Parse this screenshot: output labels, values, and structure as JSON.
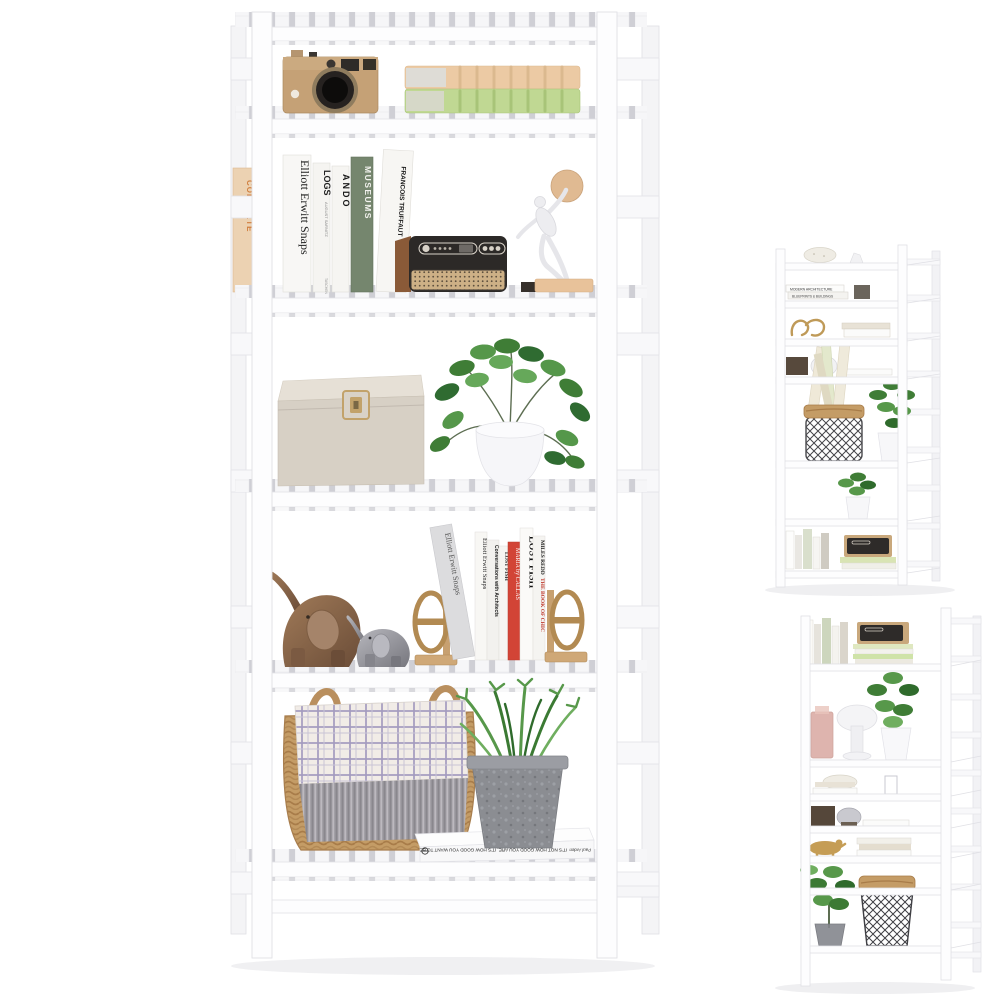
{
  "image": {
    "type": "product-photo",
    "subject": "6-tier white slatted bamboo bookshelf styled with decor, shown in one large front view and two smaller angled views",
    "background": "#ffffff",
    "views": {
      "main_front_view": {
        "tiers": "6",
        "shelf_items": {
          "tier1": [
            "vintage camera (tan with black lens)",
            "two stacked books (peach and green)"
          ],
          "tier2": [
            "leaning peach book",
            "book row: Elliott Erwitt Snaps / LOGS / ANDO / MUSEUMS / Francois Truffaut",
            "retro speaker radio (dark front, wood side, tan grille)",
            "white discus-thrower statue with tan disc on base"
          ],
          "tier3": [
            "beige linen storage box with gold clasp",
            "green plant in white pot"
          ],
          "tier4": [
            "bronze elephant figurine",
            "silver elephant figurine",
            "gold oval bookend pair",
            "book row: Elliott Erwitt Snaps / Conversations with Architects / Lost Fish / Maria by Callas / Miles Redd"
          ],
          "tier5": [
            "wicker basket with plaid fringed blanket",
            "succulent plant in grey concrete pot on white book"
          ]
        }
      },
      "angled_view_top_right": {
        "items": [
          "speckled bowl",
          "flat book stacks",
          "gold ornament",
          "dark box with silver dome lamp",
          "tall opening with wire basket of rolled posters and green plant",
          "white potted plant",
          "standing books with radio on stacked books"
        ]
      },
      "angled_view_bottom_right": {
        "items": [
          "standing books and radio on stacked books",
          "green plant in white pot",
          "rose glass candle holder",
          "white mushroom lamp",
          "bowl with flat books",
          "dark box with silver dome",
          "gold animal figurine",
          "leafy plant in grey pot",
          "wire basket with wicker rim"
        ]
      }
    }
  },
  "colors": {
    "shelf_white": "#fdfdfe",
    "shelf_edge": "#e2e2e7",
    "slat_gap": "#cfcfd5",
    "camera_body": "#c5a176",
    "book_peach": "#eccaa4",
    "book_green": "#c0d893",
    "museums_spine": "#75866e",
    "radio_front": "#2c2927",
    "radio_wood": "#8a5a38",
    "radio_grille": "#cdb086",
    "statue_white": "#ededf0",
    "statue_disc": "#e0ba92",
    "box_linen": "#d7d0c5",
    "clasp_gold": "#c2a26a",
    "leaf_green": "#3f7d36",
    "elephant_bronze": "#8a6750",
    "elephant_silver": "#9d9da4",
    "bookend_gold": "#b28a52",
    "maria_red": "#d24436",
    "wicker": "#c49c66",
    "plaid_line": "#a39bc0",
    "fringe_grey": "#9a979d",
    "concrete_pot": "#8b8d92"
  },
  "texts": {
    "elliott": "Elliott Erwitt Snaps",
    "logs": "LOGS",
    "logs_sub": "AUGUST SARNITZ",
    "ando": "ANDO",
    "museums": "MUSEUMS",
    "truffaut": "FRANCOIS TRUFFAUT",
    "truffaut_sub": "The Complete Films",
    "taschen": "TASCHEN",
    "complete": "COMPLETE",
    "conversations": "Conversations with Architects",
    "lost_fish": "LOST FISH",
    "maria": "MARIA by CALLAS",
    "miles": "MILES REDD",
    "chic": "THE BOOK OF CHIC",
    "flat_title": "IT'S NOT HOW GOOD YOU ARE, IT'S HOW GOOD YOU WANT TO BE.",
    "flat_author": "Paul Arden",
    "modern_arch": "MODERN ARCHITECTURE",
    "blueprints": "BLUEPRINTS & BUILDINGS"
  }
}
